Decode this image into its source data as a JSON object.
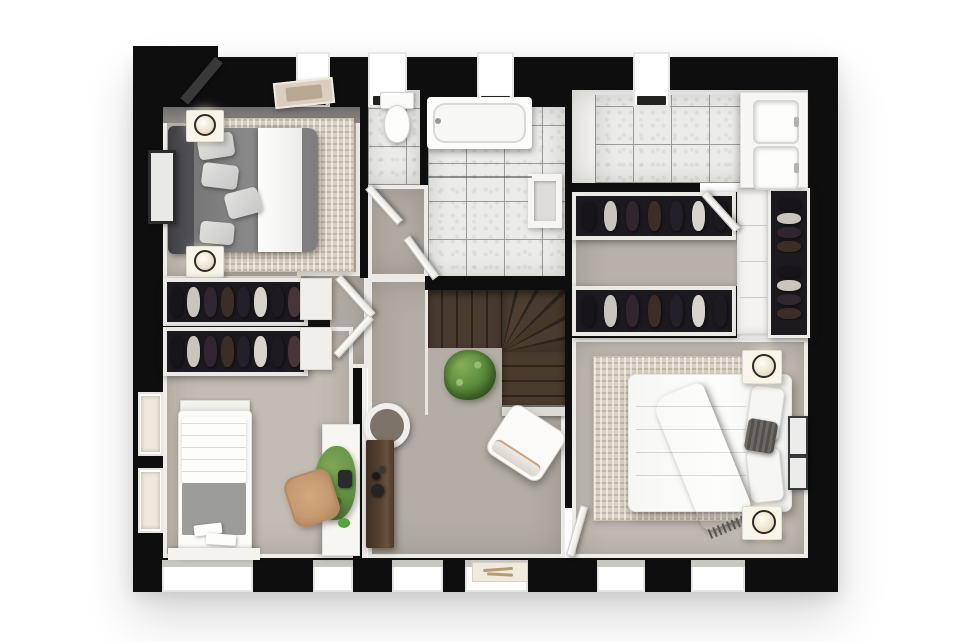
{
  "scene": {
    "kind": "3d-floor-plan-render",
    "view": "top-down",
    "background": "#ffffff"
  },
  "palette": {
    "wall": "#0f0e0e",
    "carpet_master": "#c6c0b8",
    "carpet_hall": "#b3ada6",
    "carpet_light": "#b7b1aa",
    "carpet_warm": "#c2bcb4",
    "tile": "#ebebe9",
    "grout": "#9b9b99",
    "rug": "#d9d1c1",
    "wood_a": "#4a3b2f",
    "wood_b": "#2e241d",
    "wood_console": "#53402f",
    "plant": "#5f8f3e",
    "plant_dark": "#47702e",
    "tan": "#c59a70",
    "throw": "#5d5955",
    "clothes_bg": "#1c1a1e"
  },
  "clothes_colors": [
    "#17151a",
    "#c9c4bd",
    "#2f2630",
    "#3b2e26",
    "#23202a",
    "#d8d4cd",
    "#1d1a20",
    "#45363a"
  ],
  "config": {
    "wardrobe_bundles": 8,
    "walkin_bundles": 7,
    "shelf_bundles": 4,
    "top_windows": 4,
    "bottom_windows": 6,
    "left_windows": 2
  },
  "rooms": [
    {
      "id": "master-bedroom",
      "position": "top-left",
      "furniture": [
        "double-bed",
        "gray-duvet-with-white-runner",
        "dark-headboard",
        "area-rug",
        "nightstand-top",
        "nightstand-bottom",
        "table-lamps",
        "wall-art",
        "built-in-wardrobe",
        "ceiling-light"
      ]
    },
    {
      "id": "bathroom",
      "position": "top-center",
      "furniture": [
        "bathtub",
        "toilet",
        "wall-niche",
        "marble-tile-floor",
        "shower-screen"
      ]
    },
    {
      "id": "ensuite-bathroom",
      "position": "top-right",
      "furniture": [
        "double-vanity",
        "sink-top",
        "sink-bottom",
        "marble-tile-floor"
      ]
    },
    {
      "id": "walk-in-wardrobe",
      "position": "center-right",
      "furniture": [
        "clothes-rail-top",
        "clothes-rail-bottom",
        "tall-cabinet",
        "open-shelving-with-clothes"
      ]
    },
    {
      "id": "landing-hallway",
      "position": "center",
      "furniture": [
        "winder-staircase",
        "stair-railing",
        "potted-plant",
        "round-mirror",
        "console-table",
        "console-decor",
        "armchair"
      ]
    },
    {
      "id": "bedroom-2",
      "position": "right",
      "furniture": [
        "double-bed",
        "fringed-throw-blanket",
        "pillows",
        "knit-cushion",
        "area-rug",
        "nightstand-top",
        "nightstand-bottom",
        "glowing-table-lamps",
        "wall-art-frames",
        "window-sill-decor"
      ]
    },
    {
      "id": "bedroom-3",
      "position": "bottom-left",
      "furniture": [
        "single-bed",
        "folded-towels",
        "desk",
        "desk-plant",
        "desk-lamp",
        "office-chair",
        "built-in-wardrobe",
        "window-bench"
      ]
    }
  ],
  "doors": [
    "wc-door",
    "bathroom-door",
    "walk-in-wardrobe-door",
    "bedroom-2-door",
    "master-bedroom-door",
    "bedroom-3-door",
    "master-entry-dark-door"
  ]
}
